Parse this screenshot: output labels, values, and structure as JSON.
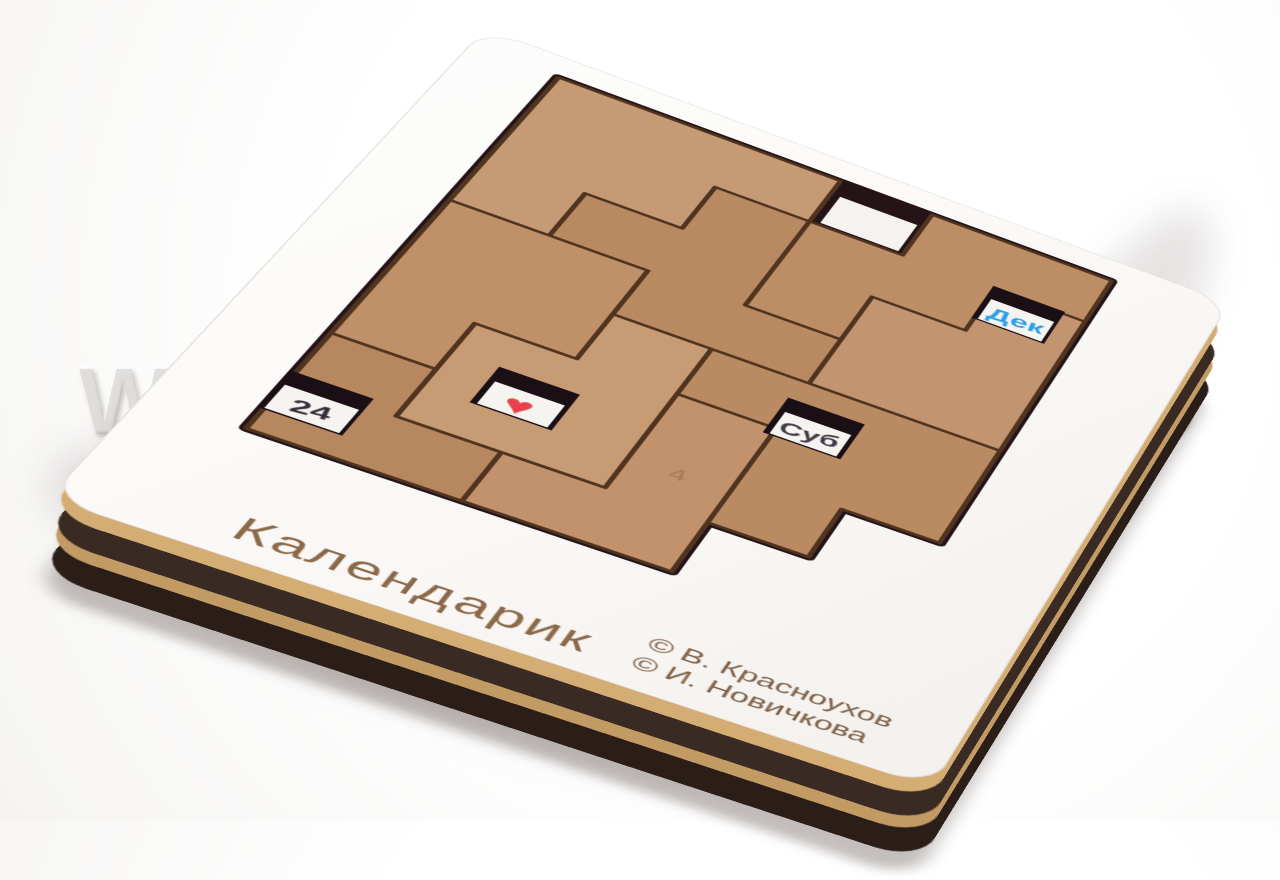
{
  "watermark": {
    "text": "WWW.CLEVER-TOY.RU"
  },
  "board": {
    "title": "Календарик",
    "copyright_line1": "© В. Красноухов",
    "copyright_line2": "© И. Новичкова"
  },
  "windows": {
    "month": {
      "label": "Дек",
      "color": "#2d9fe8"
    },
    "day": {
      "label": "24",
      "color": "#332e3a"
    },
    "weekday": {
      "label": "Суб",
      "color": "#423a46"
    },
    "heart": {
      "glyph": "♥",
      "color": "#e8414b"
    }
  },
  "piece_mark": "4",
  "pieces": {
    "colors": [
      "#c59a74",
      "#bd8e66",
      "#c39470",
      "#b98a62",
      "#c09168",
      "#c79b73",
      "#ba8b63",
      "#c2926c",
      "#b78760"
    ]
  },
  "colors": {
    "board_white": "#fcfbfa",
    "tray_shadow": "#241418",
    "window_hole": "#1a0f14",
    "paper_white": "#f6f4f1",
    "edge_dark": "#2b1e19",
    "edge_tan": "#c29a64",
    "engraving_brown": "#8b6847",
    "copyright_brown": "#7c5e44"
  }
}
